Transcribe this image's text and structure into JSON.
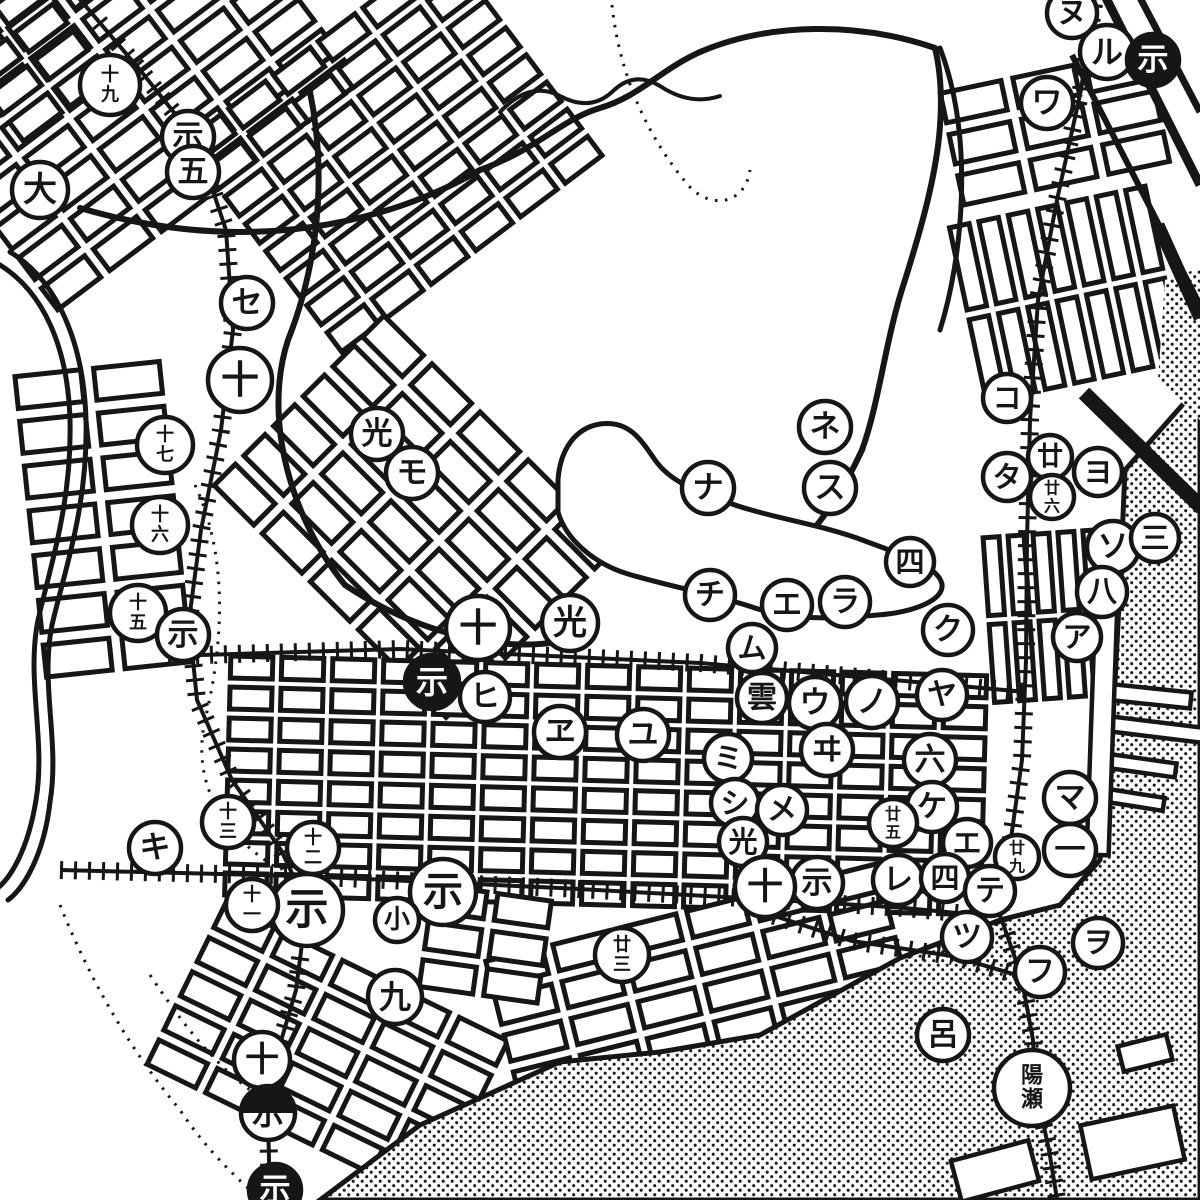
{
  "map": {
    "title": "old-japanese-city-map-scan",
    "size": {
      "w": 1200,
      "h": 1200
    },
    "paper": "#ffffff",
    "ink": "#161616",
    "watermark": {
      "text": "oldmap.shop",
      "fill": "#ededed",
      "outline": "#9a9a9a",
      "opacity": 0.62,
      "font_size": 86
    },
    "legend_hint": "circled block numbers (kanji numerals) and circled iroha katakana markers"
  },
  "watermarks": [
    {
      "x": 22,
      "y": 282
    },
    {
      "x": 660,
      "y": 282
    },
    {
      "x": 358,
      "y": 642
    },
    {
      "x": -18,
      "y": 972
    },
    {
      "x": 680,
      "y": 968
    }
  ],
  "labels": [
    {
      "text": "州",
      "x": 765,
      "y": 185,
      "fs": 74,
      "name": "district-label-shu"
    },
    {
      "text": "町",
      "x": 700,
      "y": 355,
      "fs": 64,
      "name": "district-label-machi"
    },
    {
      "text": "榮",
      "x": 930,
      "y": 225,
      "fs": 58,
      "name": "district-label-sakae"
    },
    {
      "text": "町",
      "x": 920,
      "y": 322,
      "fs": 58,
      "name": "district-label-sakae-machi"
    },
    {
      "text": "塩",
      "x": 744,
      "y": 6,
      "fs": 52,
      "name": "district-label-partial-top"
    },
    {
      "text": "金",
      "x": 600,
      "y": 1192,
      "fs": 46,
      "name": "district-label-partial-bottom"
    },
    {
      "text": "开",
      "x": 854,
      "y": 796,
      "fs": 20,
      "name": "small-label-hill"
    }
  ],
  "vertical_labels": [
    {
      "chars": [
        "龍",
        "瀬",
        "山"
      ],
      "x": 827,
      "y": 768,
      "fs": 17,
      "dy": 21,
      "name": "hill-name-label"
    },
    {
      "chars": [
        "港",
        "川"
      ],
      "x": 552,
      "y": 1122,
      "fs": 16,
      "dy": 27,
      "name": "river-name-label"
    }
  ],
  "markers": [
    {
      "g": "十九",
      "x": 110,
      "y": 85,
      "r": 30,
      "v": "plain",
      "stack": true
    },
    {
      "g": "示",
      "x": 188,
      "y": 137,
      "r": 26,
      "v": "plain"
    },
    {
      "g": "五",
      "x": 193,
      "y": 172,
      "r": 26,
      "v": "plain"
    },
    {
      "g": "大",
      "x": 40,
      "y": 190,
      "r": 28,
      "v": "plain"
    },
    {
      "g": "セ",
      "x": 247,
      "y": 303,
      "r": 26,
      "v": "plain"
    },
    {
      "g": "十",
      "x": 240,
      "y": 380,
      "r": 32,
      "v": "plain"
    },
    {
      "g": "十七",
      "x": 165,
      "y": 445,
      "r": 28,
      "v": "plain",
      "stack": true
    },
    {
      "g": "十六",
      "x": 160,
      "y": 525,
      "r": 28,
      "v": "plain",
      "stack": true
    },
    {
      "g": "十五",
      "x": 138,
      "y": 613,
      "r": 28,
      "v": "plain",
      "stack": true
    },
    {
      "g": "示",
      "x": 183,
      "y": 635,
      "r": 26,
      "v": "plain"
    },
    {
      "g": "光",
      "x": 377,
      "y": 434,
      "r": 26,
      "v": "plain"
    },
    {
      "g": "モ",
      "x": 412,
      "y": 473,
      "r": 26,
      "v": "plain"
    },
    {
      "g": "ネ",
      "x": 825,
      "y": 427,
      "r": 26,
      "v": "plain"
    },
    {
      "g": "ス",
      "x": 830,
      "y": 488,
      "r": 26,
      "v": "plain"
    },
    {
      "g": "ナ",
      "x": 708,
      "y": 488,
      "r": 26,
      "v": "plain"
    },
    {
      "g": "四",
      "x": 910,
      "y": 562,
      "r": 24,
      "v": "plain"
    },
    {
      "g": "コ",
      "x": 1007,
      "y": 398,
      "r": 24,
      "v": "plain"
    },
    {
      "g": "タ",
      "x": 1007,
      "y": 477,
      "r": 24,
      "v": "plain"
    },
    {
      "g": "廿",
      "x": 1050,
      "y": 457,
      "r": 22,
      "v": "plain"
    },
    {
      "g": "廿六",
      "x": 1052,
      "y": 497,
      "r": 22,
      "v": "plain",
      "stack": true
    },
    {
      "g": "ヨ",
      "x": 1098,
      "y": 472,
      "r": 24,
      "v": "plain"
    },
    {
      "g": "ソ",
      "x": 1113,
      "y": 547,
      "r": 26,
      "v": "plain"
    },
    {
      "g": "三",
      "x": 1155,
      "y": 538,
      "r": 24,
      "v": "plain"
    },
    {
      "g": "八",
      "x": 1102,
      "y": 592,
      "r": 25,
      "v": "plain"
    },
    {
      "g": "ア",
      "x": 1077,
      "y": 637,
      "r": 24,
      "v": "plain"
    },
    {
      "g": "チ",
      "x": 710,
      "y": 595,
      "r": 25,
      "v": "plain"
    },
    {
      "g": "エ",
      "x": 787,
      "y": 605,
      "r": 25,
      "v": "plain"
    },
    {
      "g": "ラ",
      "x": 845,
      "y": 602,
      "r": 25,
      "v": "plain"
    },
    {
      "g": "ム",
      "x": 752,
      "y": 648,
      "r": 24,
      "v": "plain"
    },
    {
      "g": "十",
      "x": 478,
      "y": 628,
      "r": 32,
      "v": "plain"
    },
    {
      "g": "光",
      "x": 570,
      "y": 623,
      "r": 28,
      "v": "plain"
    },
    {
      "g": "ク",
      "x": 948,
      "y": 630,
      "r": 25,
      "v": "plain"
    },
    {
      "g": "ヤ",
      "x": 942,
      "y": 695,
      "r": 25,
      "v": "plain"
    },
    {
      "g": "ノ",
      "x": 872,
      "y": 702,
      "r": 26,
      "v": "plain"
    },
    {
      "g": "ウ",
      "x": 815,
      "y": 703,
      "r": 26,
      "v": "plain"
    },
    {
      "g": "雲",
      "x": 762,
      "y": 698,
      "r": 25,
      "v": "plain"
    },
    {
      "g": "示",
      "x": 432,
      "y": 682,
      "r": 27,
      "v": "filled"
    },
    {
      "g": "ヒ",
      "x": 485,
      "y": 697,
      "r": 25,
      "v": "plain"
    },
    {
      "g": "ヱ",
      "x": 560,
      "y": 732,
      "r": 26,
      "v": "plain"
    },
    {
      "g": "ユ",
      "x": 643,
      "y": 735,
      "r": 26,
      "v": "plain"
    },
    {
      "g": "ヰ",
      "x": 827,
      "y": 750,
      "r": 26,
      "v": "plain"
    },
    {
      "g": "ミ",
      "x": 728,
      "y": 758,
      "r": 24,
      "v": "plain"
    },
    {
      "g": "六",
      "x": 930,
      "y": 760,
      "r": 26,
      "v": "plain"
    },
    {
      "g": "シ",
      "x": 735,
      "y": 803,
      "r": 24,
      "v": "plain"
    },
    {
      "g": "メ",
      "x": 782,
      "y": 810,
      "r": 25,
      "v": "plain"
    },
    {
      "g": "ケ",
      "x": 932,
      "y": 807,
      "r": 25,
      "v": "plain"
    },
    {
      "g": "廿五",
      "x": 893,
      "y": 823,
      "r": 24,
      "v": "plain",
      "stack": true
    },
    {
      "g": "光",
      "x": 743,
      "y": 842,
      "r": 24,
      "v": "plain"
    },
    {
      "g": "エ",
      "x": 967,
      "y": 843,
      "r": 24,
      "v": "plain"
    },
    {
      "g": "マ",
      "x": 1070,
      "y": 798,
      "r": 26,
      "v": "plain"
    },
    {
      "g": "一",
      "x": 1070,
      "y": 850,
      "r": 26,
      "v": "plain"
    },
    {
      "g": "廿九",
      "x": 1017,
      "y": 857,
      "r": 22,
      "v": "plain",
      "stack": true
    },
    {
      "g": "レ",
      "x": 898,
      "y": 880,
      "r": 25,
      "v": "plain"
    },
    {
      "g": "四",
      "x": 945,
      "y": 878,
      "r": 24,
      "v": "plain"
    },
    {
      "g": "テ",
      "x": 990,
      "y": 891,
      "r": 25,
      "v": "plain"
    },
    {
      "g": "示",
      "x": 817,
      "y": 883,
      "r": 26,
      "v": "plain"
    },
    {
      "g": "十",
      "x": 765,
      "y": 887,
      "r": 30,
      "v": "plain"
    },
    {
      "g": "示",
      "x": 307,
      "y": 910,
      "r": 36,
      "v": "plain"
    },
    {
      "g": "示",
      "x": 443,
      "y": 892,
      "r": 33,
      "v": "plain"
    },
    {
      "g": "小",
      "x": 397,
      "y": 920,
      "r": 22,
      "v": "plain"
    },
    {
      "g": "キ",
      "x": 155,
      "y": 848,
      "r": 26,
      "v": "plain"
    },
    {
      "g": "十三",
      "x": 228,
      "y": 822,
      "r": 26,
      "v": "plain",
      "stack": true
    },
    {
      "g": "十二",
      "x": 313,
      "y": 848,
      "r": 26,
      "v": "plain",
      "stack": true
    },
    {
      "g": "十一",
      "x": 252,
      "y": 905,
      "r": 26,
      "v": "plain",
      "stack": true
    },
    {
      "g": "廿三",
      "x": 622,
      "y": 955,
      "r": 27,
      "v": "plain",
      "stack": true
    },
    {
      "g": "九",
      "x": 395,
      "y": 997,
      "r": 27,
      "v": "plain"
    },
    {
      "g": "十",
      "x": 262,
      "y": 1060,
      "r": 28,
      "v": "plain"
    },
    {
      "g": "示",
      "x": 268,
      "y": 1113,
      "r": 27,
      "v": "half"
    },
    {
      "g": "示",
      "x": 275,
      "y": 1190,
      "r": 26,
      "v": "filled"
    },
    {
      "g": "ツ",
      "x": 967,
      "y": 937,
      "r": 25,
      "v": "plain"
    },
    {
      "g": "フ",
      "x": 1040,
      "y": 972,
      "r": 25,
      "v": "plain"
    },
    {
      "g": "ヲ",
      "x": 1098,
      "y": 943,
      "r": 25,
      "v": "plain"
    },
    {
      "g": "呂",
      "x": 943,
      "y": 1035,
      "r": 26,
      "v": "plain"
    },
    {
      "g": "陽瀬",
      "x": 1032,
      "y": 1088,
      "r": 38,
      "v": "station",
      "stack": true
    },
    {
      "g": "ヌ",
      "x": 1072,
      "y": 13,
      "r": 25,
      "v": "plain"
    },
    {
      "g": "ル",
      "x": 1107,
      "y": 52,
      "r": 27,
      "v": "plain"
    },
    {
      "g": "示",
      "x": 1153,
      "y": 60,
      "r": 26,
      "v": "filled"
    },
    {
      "g": "ワ",
      "x": 1047,
      "y": 103,
      "r": 26,
      "v": "plain"
    }
  ],
  "grids": [
    {
      "cx": 140,
      "cy": 95,
      "rot": -37,
      "cols": 6,
      "rows": 7,
      "bw": 54,
      "bh": 27,
      "gap": 11
    },
    {
      "cx": 35,
      "cy": 60,
      "rot": -37,
      "cols": 2,
      "rows": 4,
      "bw": 48,
      "bh": 24,
      "gap": 10
    },
    {
      "cx": 400,
      "cy": 150,
      "rot": -37,
      "cols": 6,
      "rows": 8,
      "bw": 46,
      "bh": 24,
      "gap": 10
    },
    {
      "cx": 110,
      "cy": 525,
      "rot": -6,
      "cols": 2,
      "rows": 7,
      "bw": 66,
      "bh": 32,
      "gap": 13
    },
    {
      "cx": 415,
      "cy": 525,
      "rot": 45,
      "cols": 5,
      "rows": 6,
      "bw": 56,
      "bh": 30,
      "gap": 12
    },
    {
      "cx": 1062,
      "cy": 300,
      "rot": 78,
      "cols": 2,
      "rows": 7,
      "bw": 84,
      "bh": 20,
      "gap": 10
    },
    {
      "cx": 1062,
      "cy": 132,
      "rot": -12,
      "cols": 3,
      "rows": 3,
      "bw": 62,
      "bh": 30,
      "gap": 12
    },
    {
      "cx": 610,
      "cy": 790,
      "rot": 1.5,
      "cols": 15,
      "rows": 8,
      "bw": 42,
      "bh": 22,
      "gap": 9
    },
    {
      "cx": 1055,
      "cy": 620,
      "rot": 86,
      "cols": 2,
      "rows": 6,
      "bw": 78,
      "bh": 16,
      "gap": 9
    },
    {
      "cx": 330,
      "cy": 1060,
      "rot": 26,
      "cols": 5,
      "rows": 5,
      "bw": 54,
      "bh": 27,
      "gap": 11
    },
    {
      "cx": 705,
      "cy": 985,
      "rot": -14,
      "cols": 6,
      "rows": 4,
      "bw": 58,
      "bh": 27,
      "gap": 11
    },
    {
      "cx": 490,
      "cy": 950,
      "rot": 8,
      "cols": 2,
      "rows": 3,
      "bw": 54,
      "bh": 27,
      "gap": 11
    }
  ],
  "roads": [
    {
      "d": "M80,208 C250,258 390,222 480,170 C540,148 560,120 600,108 C640,96 660,70 700,52 C770,22 860,22 935,48",
      "w": 6
    },
    {
      "d": "M310,92 C330,190 312,280 288,340 C262,420 292,520 345,585",
      "w": 6
    },
    {
      "d": "M935,48 C952,120 930,200 905,280 C885,340 880,400 862,450",
      "w": 6
    },
    {
      "d": "M862,450 C830,520 790,560 745,595",
      "w": 6
    },
    {
      "d": "M345,585 C430,642 520,652 565,640",
      "w": 6
    },
    {
      "d": "M940,48 C975,140 962,260 940,330",
      "w": 5
    },
    {
      "d": "M500,112 Q530,80 560,96 Q590,112 612,92 Q634,70 660,86 Q690,106 720,96",
      "w": 4
    },
    {
      "d": "M-5,262 C45,290 68,350 70,420 C72,500 52,560 38,620 C26,680 46,740 36,800 C28,850 10,880 -5,890",
      "w": 5
    },
    {
      "d": "M10,252 C60,282 84,348 86,420 C88,505 66,565 52,625 C40,685 60,742 50,802 C44,855 24,888 8,900",
      "w": 5
    }
  ],
  "bold_lines": [
    {
      "d": "M1103,-8 L1200,185",
      "w": 9
    },
    {
      "d": "M1137,-8 L1200,112",
      "w": 7
    },
    {
      "d": "M1072,55 L1200,305",
      "w": 6
    },
    {
      "d": "M1158,225 L1200,318",
      "w": 13
    },
    {
      "d": "M1084,393 L1202,508",
      "w": 15
    }
  ],
  "railways": [
    {
      "name": "rail-northwest",
      "d": "M72,-10 L140,70 L196,140 L226,230 L233,330 L221,430 L201,530 L189,620 L197,700 L232,780 L281,850 L307,905 L296,990 L276,1058 L268,1115 L270,1205"
    },
    {
      "name": "rail-east",
      "d": "M1096,-10 L1081,90 L1057,200 L1038,300 L1030,420 L1027,540 L1026,660 L1022,760 L1008,860 L1000,915 L1021,975 L1033,1040 L1036,1090 L1049,1150 L1058,1205"
    },
    {
      "name": "rail-main-south",
      "d": "M60,870 L300,876 L560,888 L762,899 L905,908 L988,916"
    },
    {
      "name": "rail-branch",
      "d": "M747,907 L852,941 L952,956 L1020,976"
    },
    {
      "name": "rail-center",
      "d": "M168,656 L400,649 L700,663 L905,681 L1026,692"
    }
  ],
  "contours": [
    {
      "d": "M612,5 C620,80 650,140 688,185 C710,210 745,205 750,170"
    },
    {
      "d": "M195,485 C230,560 222,650 205,720 C190,790 230,840 280,870"
    },
    {
      "d": "M60,905 C90,980 130,1050 180,1110 C210,1155 240,1180 255,1195"
    },
    {
      "d": "M150,975 C180,1020 210,1060 250,1090"
    }
  ],
  "hill_outline": {
    "d": "M558,480 C560,450 575,428 600,424 C628,420 640,438 655,460 C672,484 700,492 735,505 C772,518 820,524 865,541 C905,556 938,566 942,584 C944,600 915,612 878,615 C838,618 795,622 752,607 C712,594 668,586 628,574 C595,564 566,540 558,512 Z",
    "w": 5
  },
  "sea": {
    "main_poly": "1125,470 1200,385 1200,1200 320,1200 420,1125 560,1062 660,1052 760,1035 900,958 1000,920 1060,905 1100,860 1112,740 1120,585",
    "patch_poly": "1165,280 1200,268 1200,420 1158,380",
    "dot_color": "#1c1c1c"
  },
  "piers": [
    {
      "x": 1105,
      "y": 688,
      "w": 86,
      "h": 16,
      "rot": 6
    },
    {
      "x": 1100,
      "y": 722,
      "w": 112,
      "h": 15,
      "rot": 7
    },
    {
      "x": 1098,
      "y": 758,
      "w": 78,
      "h": 14,
      "rot": 8
    },
    {
      "x": 1102,
      "y": 793,
      "w": 62,
      "h": 13,
      "rot": 9
    },
    {
      "x": 1092,
      "y": 545,
      "w": 22,
      "h": 310,
      "rot": 2
    },
    {
      "x": 1085,
      "y": 1115,
      "w": 95,
      "h": 55,
      "rot": -12
    },
    {
      "x": 955,
      "y": 1150,
      "w": 80,
      "h": 42,
      "rot": -15
    },
    {
      "x": 1120,
      "y": 1040,
      "w": 50,
      "h": 26,
      "rot": -14
    }
  ]
}
